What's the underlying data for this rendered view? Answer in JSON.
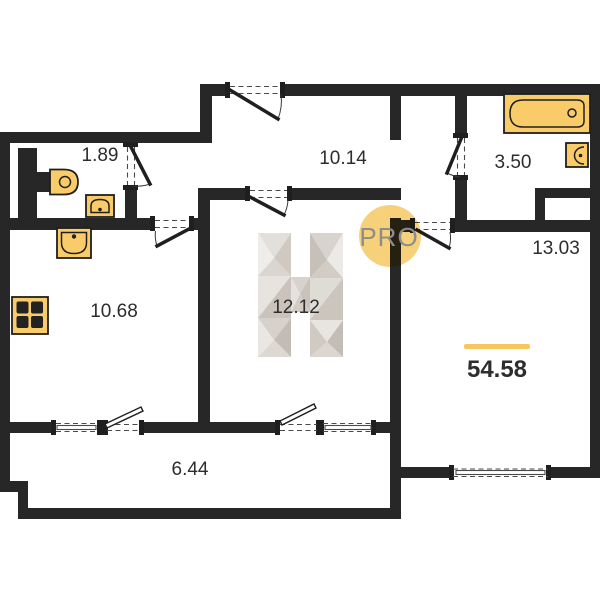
{
  "canvas": {
    "width": 600,
    "height": 600,
    "background": "#ffffff"
  },
  "palette": {
    "wall": "#272727",
    "fixture_fill": "#FACC69",
    "fixture_stroke": "#1F1F1F",
    "label_color": "#2D2D2D",
    "accent_line": "#F6C65F",
    "watermark_circle": "#F7CD6E",
    "watermark_text_color": "#8D8D89",
    "logo_facets": [
      "#EFEDEA",
      "#E3DFDA",
      "#D6D1CA",
      "#C9C3BB",
      "#DDD8D2",
      "#C2BCB4"
    ]
  },
  "rooms": [
    {
      "id": "wc",
      "area": "1.89"
    },
    {
      "id": "hallway",
      "area": "10.14"
    },
    {
      "id": "bathroom",
      "area": "3.50"
    },
    {
      "id": "living-room",
      "area": "13.03"
    },
    {
      "id": "kitchen",
      "area": "10.68"
    },
    {
      "id": "bedroom",
      "area": "12.12"
    },
    {
      "id": "balcony",
      "area": "6.44"
    }
  ],
  "total_area": "54.58",
  "watermark": "PRO",
  "fixtures": [
    "bathtub",
    "bathroom-sink",
    "toilet",
    "wc-sink",
    "kitchen-sink",
    "stove"
  ]
}
